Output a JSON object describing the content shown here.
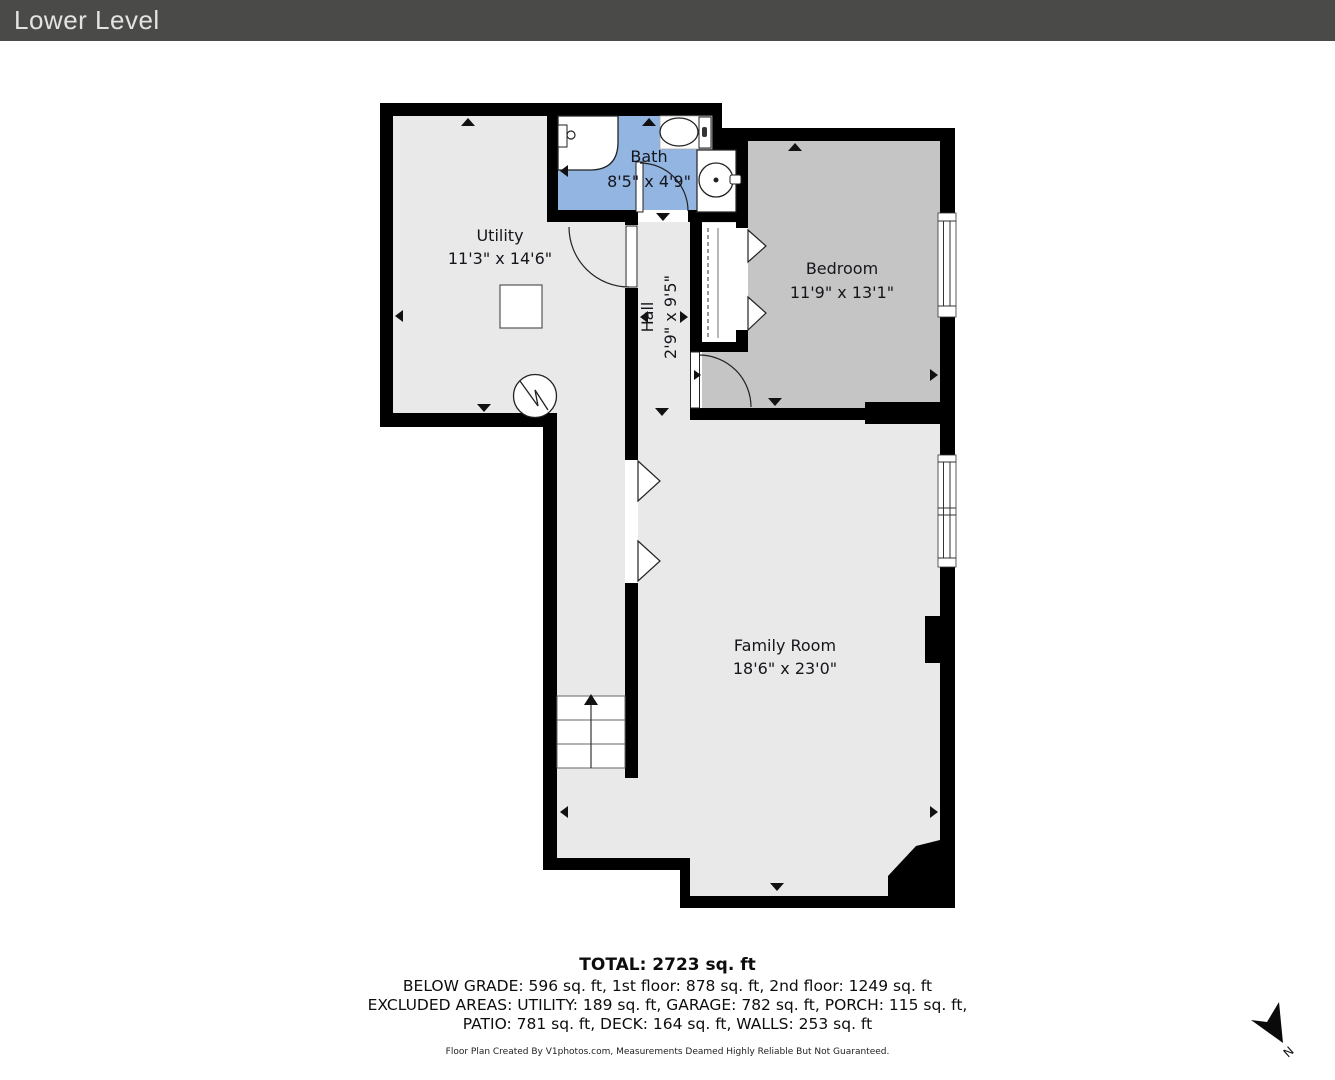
{
  "header": {
    "title": "Lower Level"
  },
  "rooms": {
    "bath": {
      "name": "Bath",
      "dims": "8'5\" x 4'9\""
    },
    "utility": {
      "name": "Utility",
      "dims": "11'3\" x 14'6\""
    },
    "bedroom": {
      "name": "Bedroom",
      "dims": "11'9\" x 13'1\""
    },
    "hall": {
      "name": "Hall",
      "dims": "2'9\" x 9'5\""
    },
    "family": {
      "name": "Family Room",
      "dims": "18'6\" x 23'0\""
    }
  },
  "summary": {
    "total": "TOTAL: 2723 sq. ft",
    "line1": "BELOW GRADE: 596 sq. ft, 1st floor: 878 sq. ft, 2nd floor: 1249 sq. ft",
    "line2": "EXCLUDED AREAS: UTILITY: 189 sq. ft, GARAGE: 782 sq. ft, PORCH: 115 sq. ft,",
    "line3": "PATIO: 781 sq. ft, DECK: 164 sq. ft, WALLS: 253 sq. ft",
    "disclaimer": "Floor Plan Created By V1photos.com, Measurements Deamed Highly Reliable But Not Guaranteed."
  },
  "compass": {
    "label": "N"
  },
  "colors": {
    "wall": "#000000",
    "floor": "#e9e9e9",
    "bath": "#92b5e2",
    "bedroom": "#c5c5c5",
    "header_bg": "#4a4a48"
  }
}
